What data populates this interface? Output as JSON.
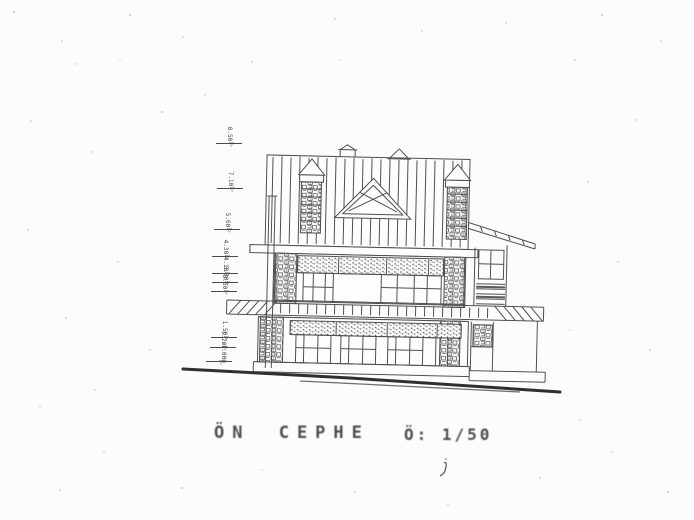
{
  "page": {
    "paper_color": "#fcfcfa",
    "ink_color": "#3d3d3d"
  },
  "caption": {
    "title": "ÖN CEPHE",
    "scale": "Ö: 1/50"
  },
  "icons": {
    "level_triangle": "▽"
  },
  "levels": [
    {
      "label": "8.50"
    },
    {
      "label": "7.10"
    },
    {
      "label": "5.60"
    },
    {
      "label": "4.30"
    },
    {
      "label": "4.10"
    },
    {
      "label": "3.80"
    },
    {
      "label": "3.50"
    },
    {
      "label": "1.50"
    },
    {
      "label": "1.20"
    },
    {
      "label": "-1.000"
    }
  ]
}
